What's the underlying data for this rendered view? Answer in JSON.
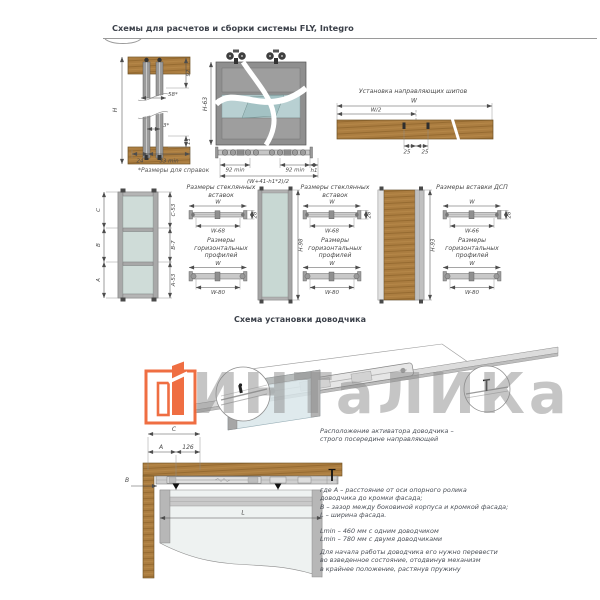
{
  "header": {
    "title": "Схемы для расчетов и сборки системы FLY, Integro"
  },
  "top_left": {
    "dim_h": "H",
    "dim_92": "92",
    "dim_58": "58*",
    "dim_3": "3*",
    "dim_11": "11",
    "dim_24": "24",
    "dim_33": "33 min",
    "footnote": "*Размеры для справок"
  },
  "top_mid": {
    "dim_h63": "H-63",
    "dim_92min_a": "92 min",
    "dim_92min_b": "92 min",
    "dim_h1": "h1",
    "formula": "(W+41-h1*2)/2"
  },
  "top_right": {
    "title": "Установка направляющих шипов",
    "dim_w": "W",
    "dim_w2": "W/2",
    "dim_25a": "25",
    "dim_25b": "25"
  },
  "middle": {
    "door1": {
      "c": "C",
      "b": "B",
      "a": "A",
      "c53": "C-53",
      "b7": "B-7",
      "a53": "A-53"
    },
    "door2": {
      "h": "H-98"
    },
    "door3": {
      "h": "H-93"
    },
    "set1": {
      "title_top": "Размеры стеклянных вставок",
      "w_top": "W",
      "w_sub_top": "W-68",
      "h_side": "28",
      "title_bot": "Размеры горизонтальных профилей",
      "w_bot": "W",
      "w_sub_bot": "W-80"
    },
    "set2": {
      "title_top": "Размеры стеклянных вставок",
      "w_top": "W",
      "w_sub_top": "W-68",
      "h_side": "28",
      "title_bot": "Размеры горизонтальных профилей",
      "w_bot": "W",
      "w_sub_bot": "W-80"
    },
    "set3": {
      "title_top": "Размеры вставки ДСП",
      "w_top": "W",
      "w_sub_top": "W-66",
      "h_side": "28",
      "title_bot": "Размеры горизонтальных профилей",
      "w_bot": "W",
      "w_sub_bot": "W-80"
    }
  },
  "closer": {
    "title": "Схема установки доводчика",
    "watermark": "ИНТаЛИКа",
    "plan": {
      "c": "C",
      "a": "A",
      "d126": "126",
      "b": "B",
      "l": "L"
    },
    "notes": {
      "p1a": "Расположение активатора доводчика –",
      "p1b": "строго посередине направляющей",
      "w1": "где A – расстояние от оси опорного ролика",
      "w2": "доводчика до кромки фасада;",
      "w3": "B – зазор между боковиной корпуса и кромкой фасада;",
      "w4": "L – ширина фасада.",
      "l1": "Lmin – 460 мм с одним доводчиком",
      "l2": "Lmin – 780 мм с двумя доводчиками",
      "f1": "Для начала работы доводчика его нужно перевести",
      "f2": "во взведенное состояние, отодвинув механизм",
      "f3": "в крайнее положение, растянув пружину"
    }
  },
  "colors": {
    "wood": "#ab7d40",
    "glass": "#c8d8d3",
    "accent_orange": "#ee6233",
    "watermark_gray": "#c9c9c9",
    "line": "#555555"
  }
}
